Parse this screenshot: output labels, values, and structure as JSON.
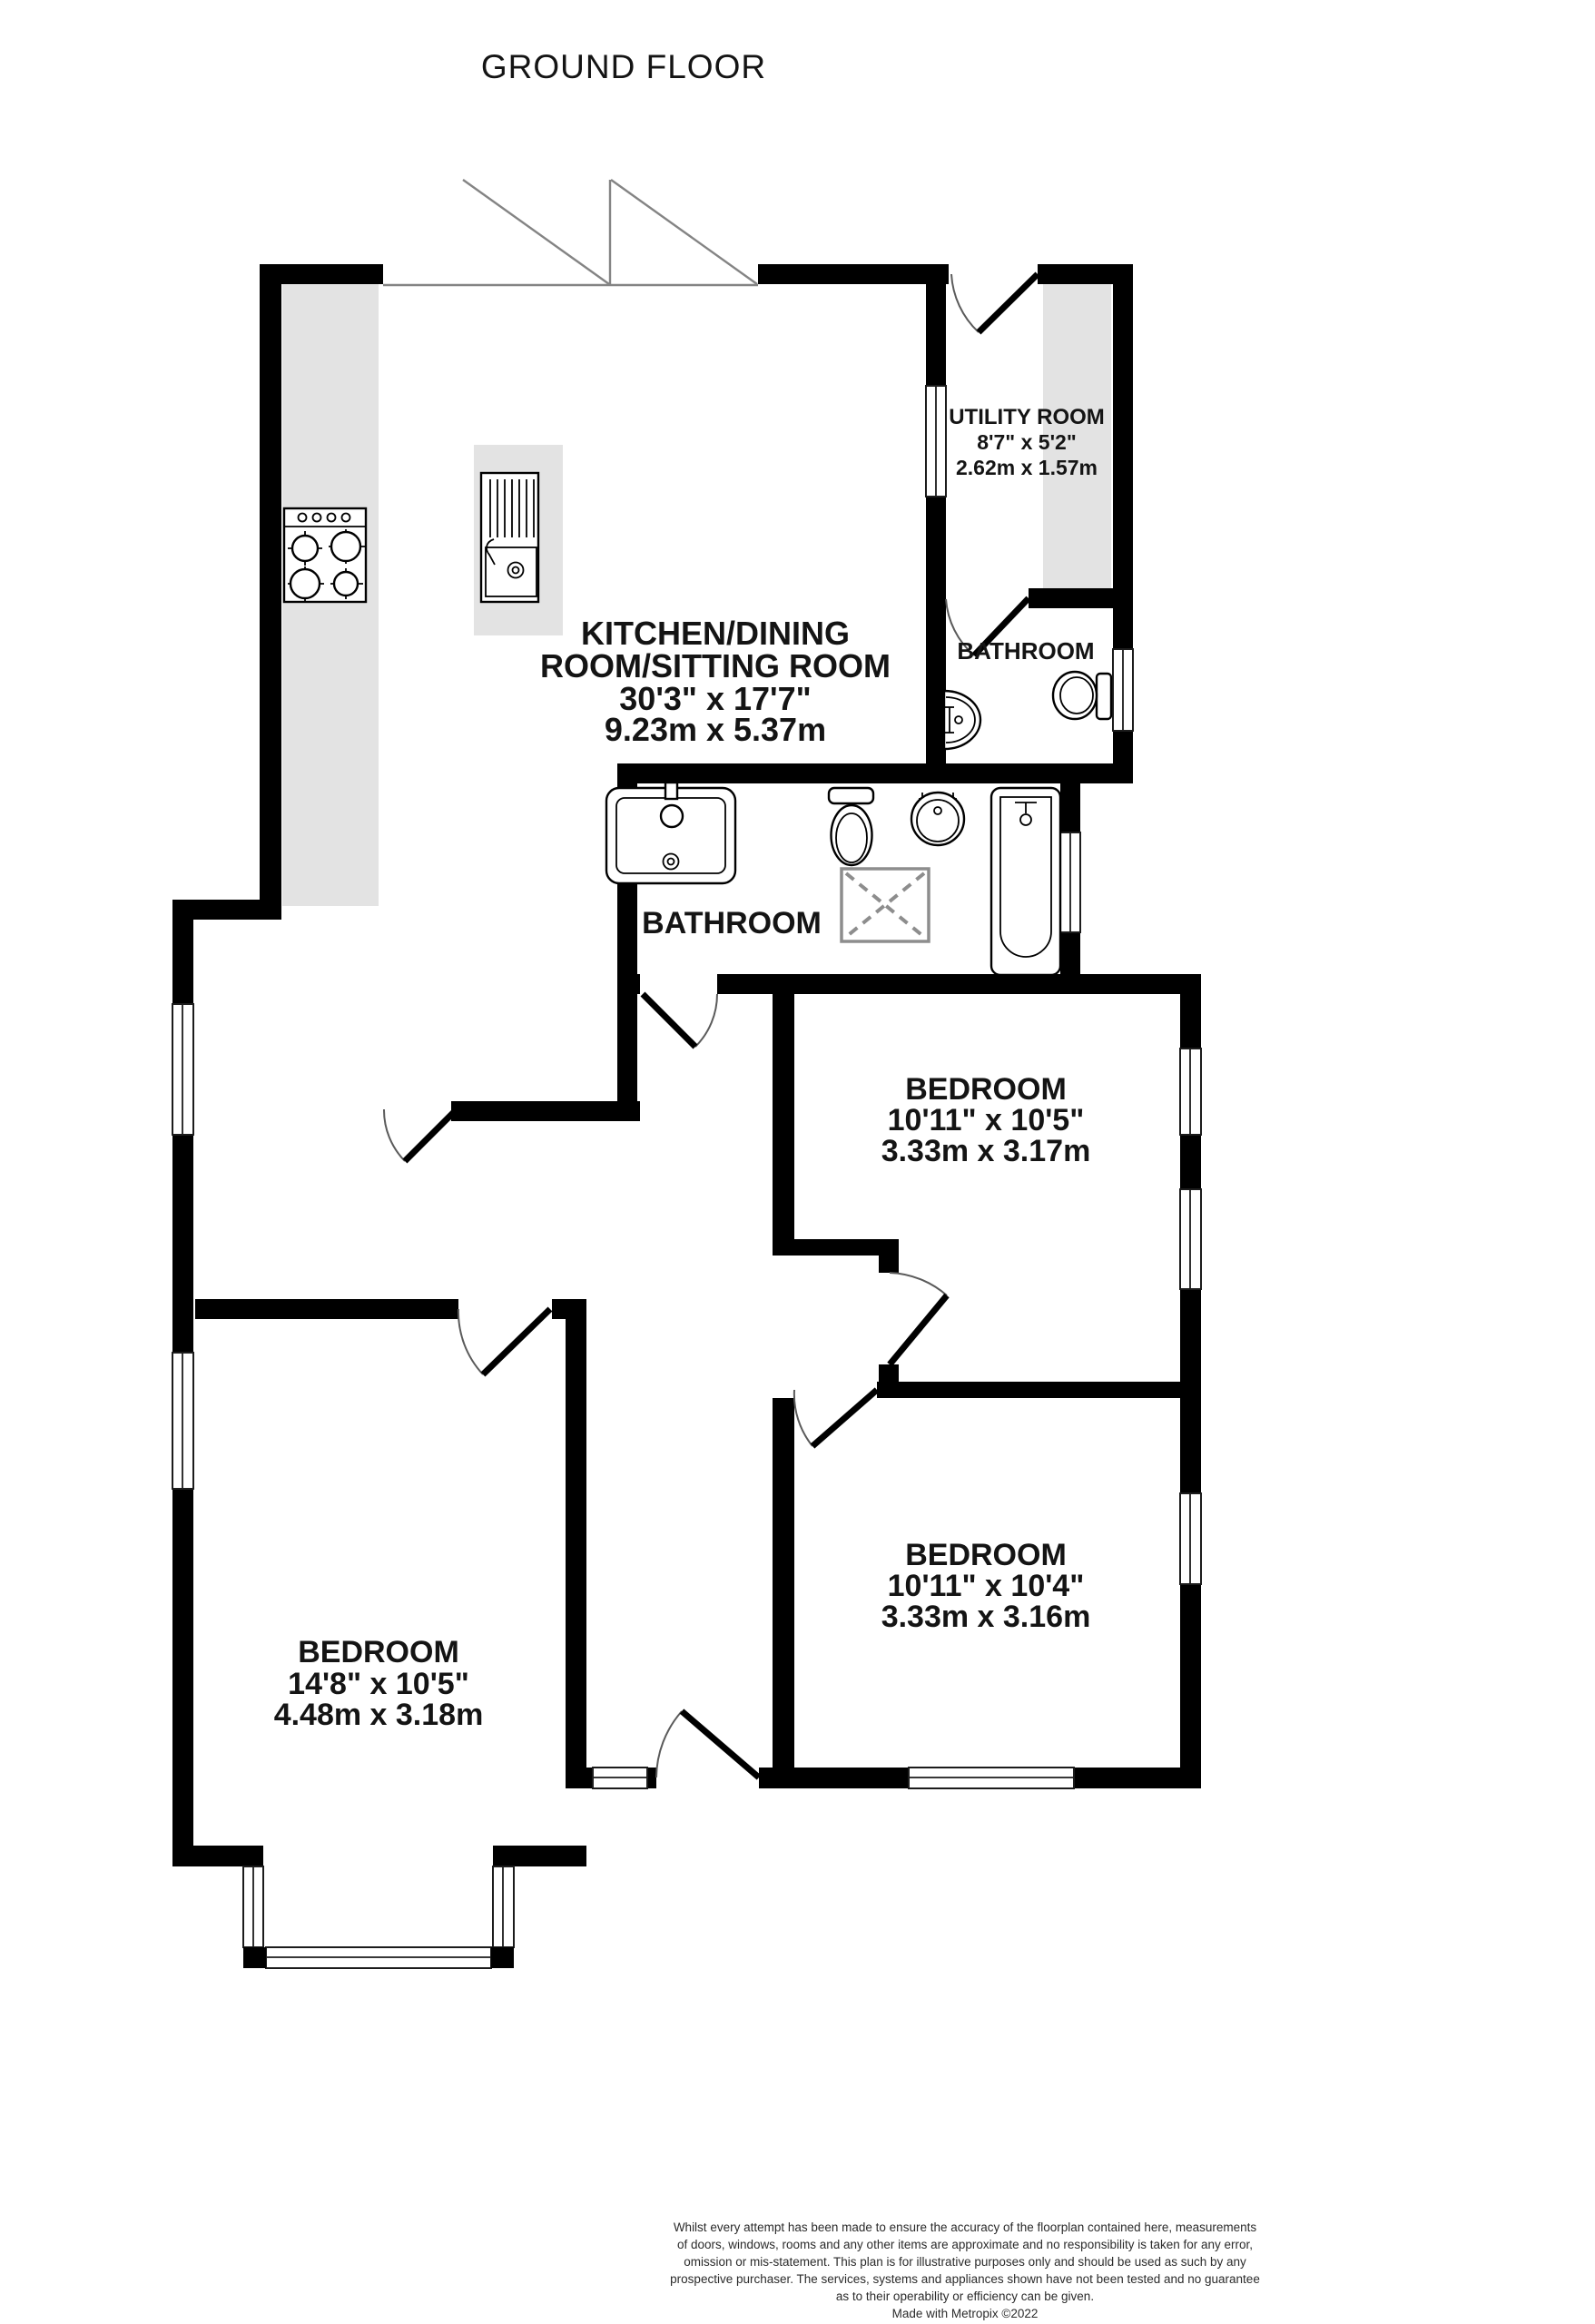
{
  "title": "GROUND FLOOR",
  "rooms": {
    "kitchen": {
      "name_line1": "KITCHEN/DINING",
      "name_line2": "ROOM/SITTING ROOM",
      "imperial": "30'3\"  x 17'7\"",
      "metric": "9.23m  x 5.37m"
    },
    "utility": {
      "name": "UTILITY ROOM",
      "imperial": "8'7\"  x 5'2\"",
      "metric": "2.62m  x 1.57m"
    },
    "bathroom_small": {
      "name": "BATHROOM"
    },
    "bathroom_main": {
      "name": "BATHROOM"
    },
    "bedroom_top_right": {
      "name": "BEDROOM",
      "imperial": "10'11\"  x 10'5\"",
      "metric": "3.33m  x 3.17m"
    },
    "bedroom_bottom_right": {
      "name": "BEDROOM",
      "imperial": "10'11\"  x 10'4\"",
      "metric": "3.33m  x 3.16m"
    },
    "bedroom_bottom_left": {
      "name": "BEDROOM",
      "imperial": "14'8\"  x 10'5\"",
      "metric": "4.48m  x 3.18m"
    }
  },
  "footer": {
    "disclaimer_lines": [
      "Whilst every attempt has been made to ensure the accuracy of the floorplan contained here, measurements",
      "of doors, windows, rooms and any other items are approximate and no responsibility is taken for any error,",
      "omission or mis-statement. This plan is for illustrative purposes only and should be used as such by any",
      "prospective purchaser. The services, systems and appliances shown have not been tested and no guarantee",
      "as to their operability or efficiency can be given."
    ],
    "credit": "Made with Metropix ©2022"
  },
  "colors": {
    "wall": "#000000",
    "counter": "#e3e3e3",
    "glazing_line": "#848484",
    "text": "#141414"
  }
}
